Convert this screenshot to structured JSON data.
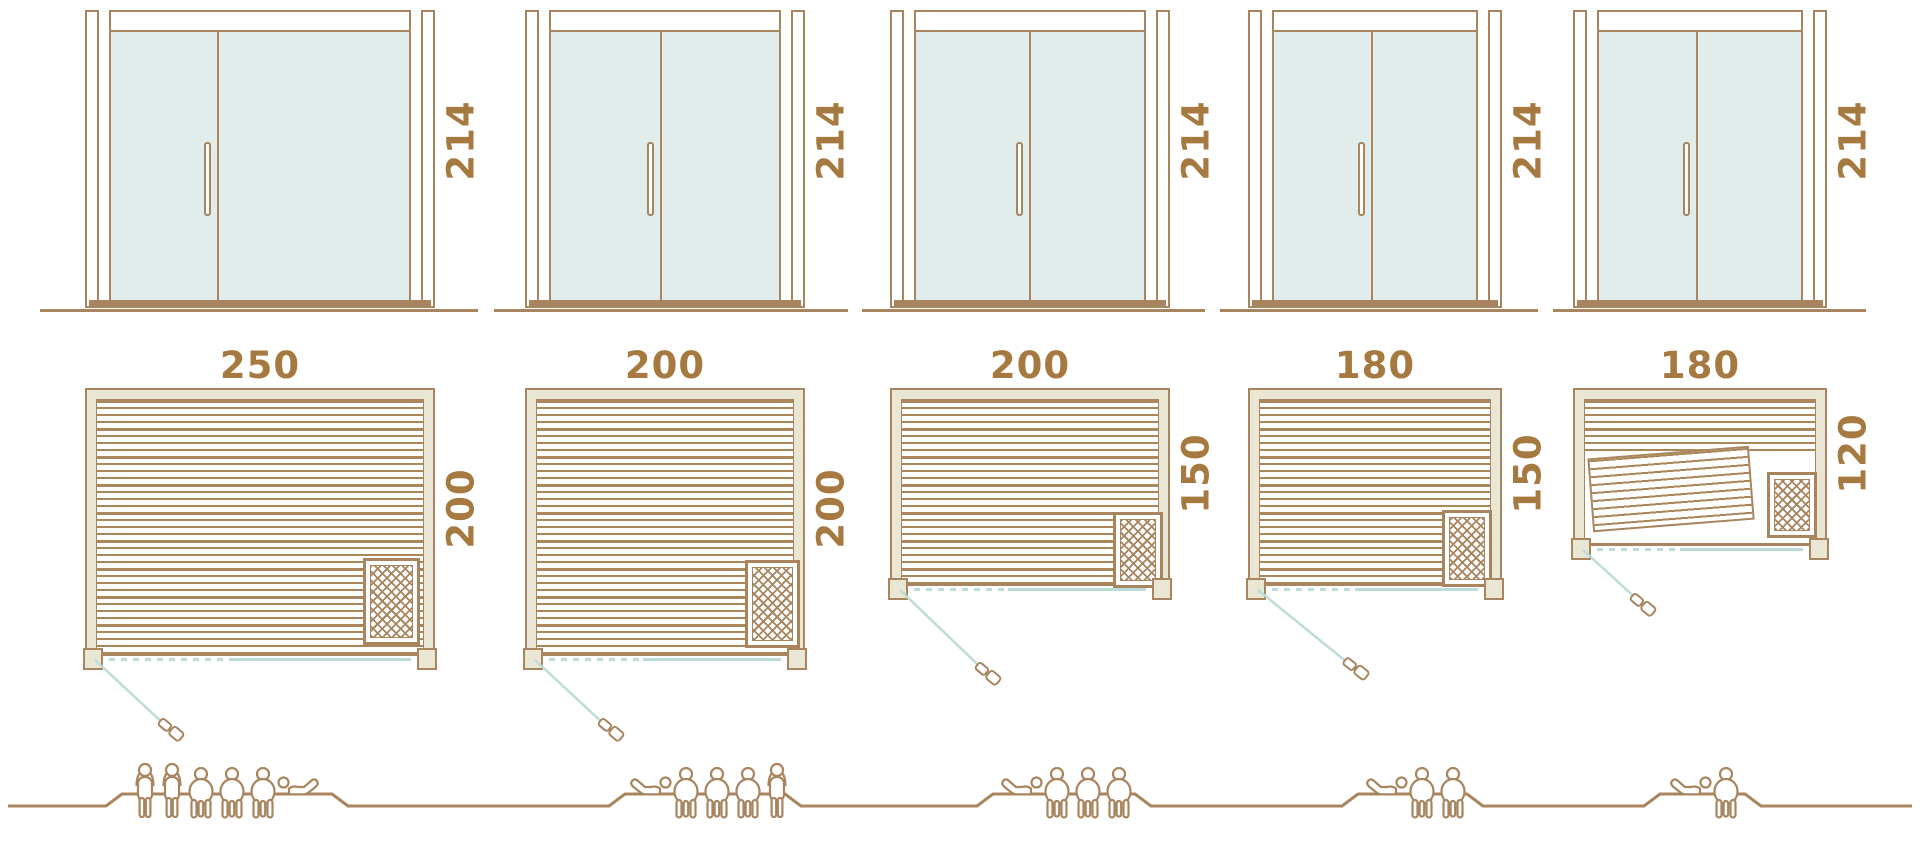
{
  "doors": [
    {
      "height_label": "214"
    },
    {
      "height_label": "214"
    },
    {
      "height_label": "214"
    },
    {
      "height_label": "214"
    },
    {
      "height_label": "214"
    }
  ],
  "plans": [
    {
      "width_label": "250",
      "depth_label": "200"
    },
    {
      "width_label": "200",
      "depth_label": "200"
    },
    {
      "width_label": "200",
      "depth_label": "150"
    },
    {
      "width_label": "180",
      "depth_label": "150"
    },
    {
      "width_label": "180",
      "depth_label": "120"
    }
  ],
  "capacity_groups": [
    {
      "count": 6,
      "figures": [
        "standing",
        "standing",
        "seated",
        "seated",
        "seated",
        "reclining-right"
      ]
    },
    {
      "count": 5,
      "figures": [
        "reclining-left",
        "seated",
        "seated",
        "seated",
        "standing"
      ]
    },
    {
      "count": 4,
      "figures": [
        "reclining-left",
        "seated",
        "seated",
        "seated"
      ]
    },
    {
      "count": 3,
      "figures": [
        "reclining-left",
        "seated",
        "seated"
      ]
    },
    {
      "count": 2,
      "figures": [
        "reclining-left",
        "seated"
      ]
    }
  ],
  "colors": {
    "line": "#a8855e",
    "text": "#a5793f",
    "glass": "#e0edea",
    "wall_fill": "#eae6d4",
    "swing": "#bcdcd7",
    "floor_stripe": "#ab8659"
  }
}
